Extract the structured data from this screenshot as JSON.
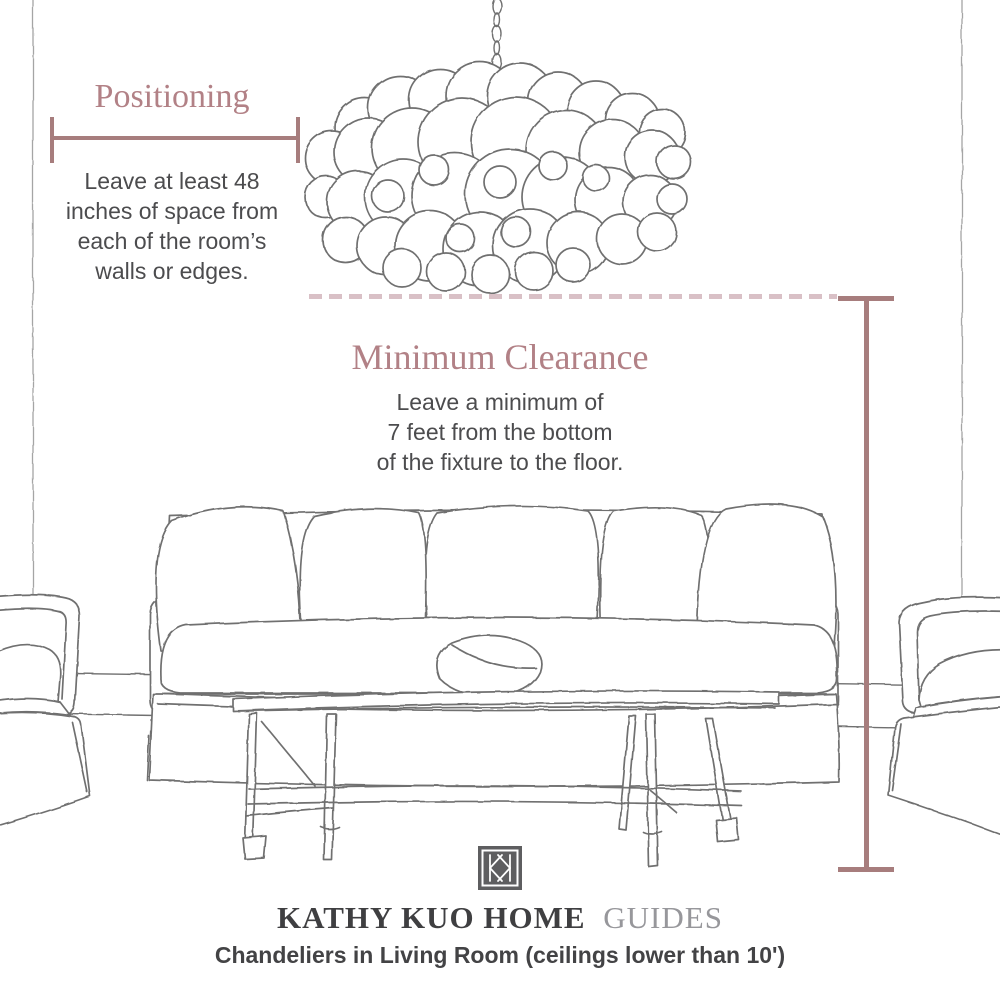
{
  "positioning": {
    "heading": "Positioning",
    "body": "Leave at least 48\ninches of space from\neach of the room’s\nwalls or edges."
  },
  "clearance": {
    "heading": "Minimum Clearance",
    "body": "Leave a minimum of\n7 feet from the bottom\nof the fixture to the floor."
  },
  "footer": {
    "brand": "KATHY KUO HOME",
    "brand_suffix": "GUIDES",
    "caption": "Chandeliers in Living Room (ceilings lower than 10')",
    "logo_icon": "kathy-kuo-monogram-icon"
  },
  "illustrations": {
    "chandelier": "bubble-chandelier-line-art",
    "furniture": [
      "sofa-with-five-back-pillows",
      "lumbar-pillow",
      "coffee-table-bench",
      "armchair-left-partial",
      "armchair-right-partial"
    ],
    "room": [
      "wall-corner-lines",
      "baseboard-lines"
    ]
  },
  "colors": {
    "heading_text": "#b28186",
    "measure_line": "#a77d7d",
    "dashed_line": "#d9c0c6",
    "body_text": "#4c4c4e",
    "brand_text": "#3f3f41",
    "brand_suffix_text": "#97979b",
    "caption_text": "#434345",
    "sketch_line": "#6f6f6f",
    "wall_line": "#a5a5a5",
    "logo_background": "#5e5e60",
    "background": "#ffffff"
  }
}
